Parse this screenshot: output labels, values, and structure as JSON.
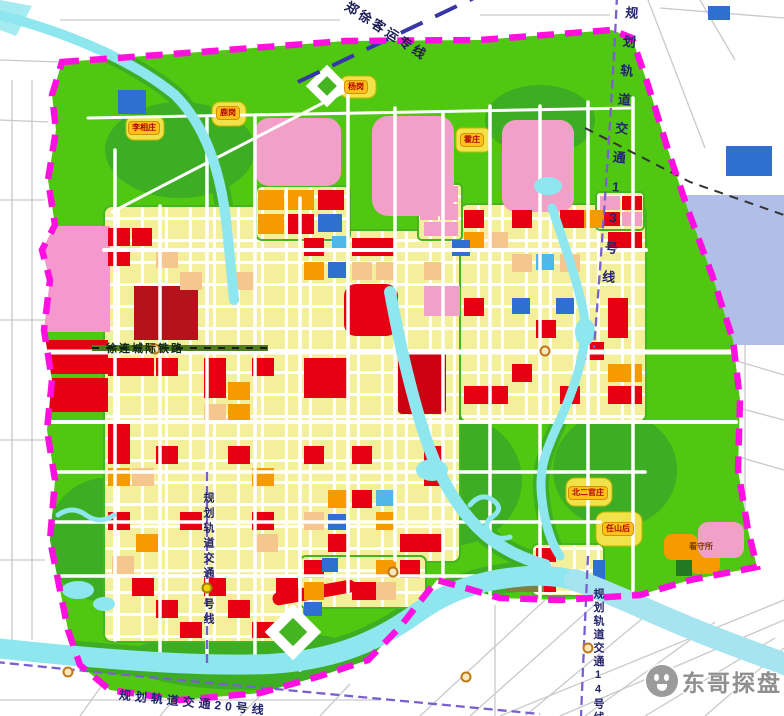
{
  "rail_labels": {
    "passenger_line": "郑徐客运专线",
    "line13": "规划轨道交通13号线",
    "line14": "规划轨道交通14号线",
    "line20": "规划轨道交通20号线",
    "intercity": "徐连城际铁路",
    "metro_central_prefix": "规划轨道交通",
    "metro_central_suffix": "号线"
  },
  "place_labels": {
    "yanggang": "杨岗",
    "lugang": "鹿岗",
    "lixiangzhuang": "李相庄",
    "huozhuang": "霍庄",
    "beierguanzhuang": "北二官庄",
    "renshanhou": "任山后",
    "kanshousuo": "看守所"
  },
  "watermark": {
    "text": "东哥探盘"
  },
  "legend_colors": {
    "residential_yellow": "#F4EF9B",
    "commercial_red": "#E60012",
    "industry_orange": "#F59B00",
    "mixed_peach": "#F6C68F",
    "special_pink": "#F2A0C8",
    "public_blue": "#2E6FD0",
    "green_space": "#50C710",
    "park_dark_green": "#3DAE23",
    "water_cyan": "#8EE6EE",
    "boundary_magenta": "#FF10E0",
    "metro_purple": "#7A5FD0"
  }
}
